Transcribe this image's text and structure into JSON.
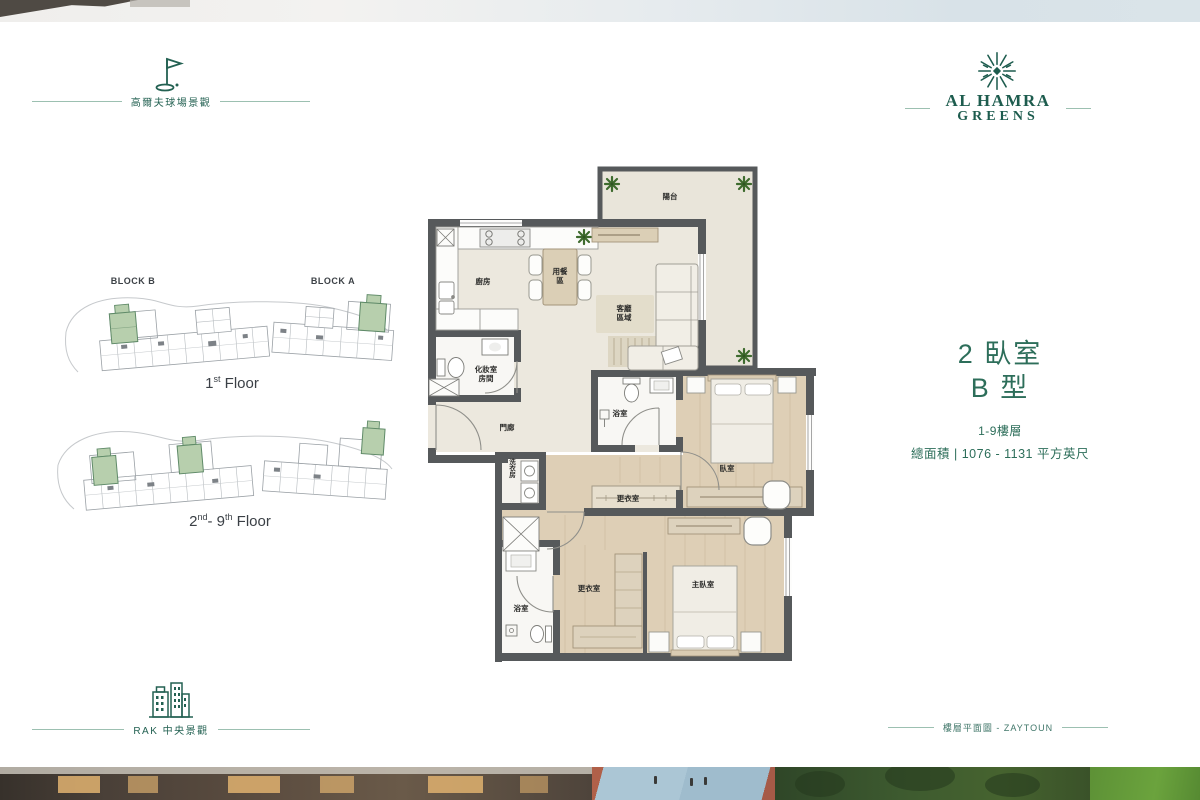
{
  "colors": {
    "brand_green": "#1e5c4e",
    "accent_green": "#2d6e5a",
    "keyplan_highlight": "#b7cfad",
    "wall_grey": "#56595b",
    "floor_beige": "#ece8de",
    "floor_wood": "#decfb6"
  },
  "header": {
    "feature": {
      "icon": "golf-flag-icon",
      "label": "高爾夫球場景觀"
    },
    "brand": {
      "icon": "starburst-logo-icon",
      "line1": "AL HAMRA",
      "line2": "GREENS"
    }
  },
  "unit": {
    "title_line1": "2 臥室",
    "title_line2": "B 型",
    "floors": "1-9樓層",
    "area": "總面積 | 1076 - 1131 平方英尺"
  },
  "keyplans": {
    "block_b": "BLOCK B",
    "block_a": "BLOCK A",
    "plan1": {
      "num": "1",
      "sup": "st",
      "rest": " Floor"
    },
    "plan2": {
      "num": "2",
      "sup": "nd",
      "mid": "- 9",
      "sup2": "th",
      "rest": " Floor"
    }
  },
  "floorplan": {
    "rooms": {
      "terrace": "陽台",
      "kitchen": "廚房",
      "dining_line1": "用餐",
      "dining_line2": "區",
      "living_line1": "客廳",
      "living_line2": "區域",
      "powder_line1": "化妝室",
      "powder_line2": "房間",
      "entry": "門廊",
      "bathroom": "浴室",
      "bedroom": "臥室",
      "closet": "更衣室",
      "laundry": "洗衣房",
      "bathroom2": "浴室",
      "closet2": "更衣室",
      "master_bedroom": "主臥室"
    }
  },
  "footer": {
    "feature": {
      "icon": "buildings-icon",
      "label": "RAK 中央景觀"
    },
    "note": "樓層平面圖 - ZAYTOUN"
  }
}
